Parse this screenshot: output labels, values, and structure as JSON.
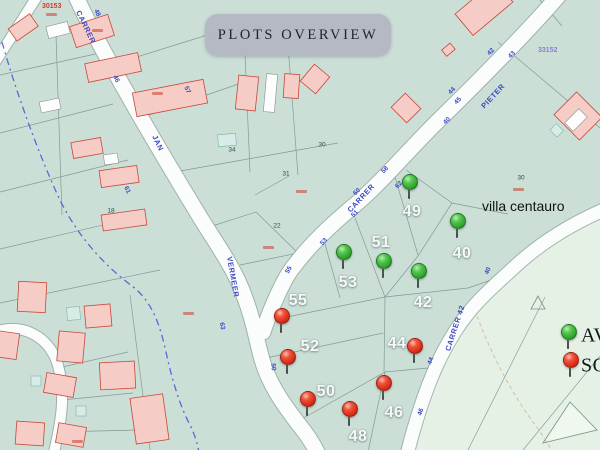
{
  "title": "PLOTS OVERVIEW",
  "area_label": "villa centauro",
  "legend": {
    "available_label": "AV",
    "sold_label": "SO",
    "available_color": "#2fa32d",
    "sold_color": "#d62b16"
  },
  "map": {
    "corner_refs": [
      {
        "text": "30153",
        "x": 42,
        "y": 3,
        "color": "#cf3a2c"
      },
      {
        "text": "33152",
        "x": 538,
        "y": 47,
        "color": "#8a7fd0"
      }
    ],
    "street_labels": [
      {
        "text": "CARRER",
        "x": 86,
        "y": 27,
        "rot": 64
      },
      {
        "text": "JAN",
        "x": 158,
        "y": 143,
        "rot": 64
      },
      {
        "text": "VERMEER",
        "x": 233,
        "y": 277,
        "rot": 80
      },
      {
        "text": "CARRER",
        "x": 361,
        "y": 198,
        "rot": -47
      },
      {
        "text": "PIETER",
        "x": 493,
        "y": 96,
        "rot": -47
      },
      {
        "text": "CARRER 42",
        "x": 455,
        "y": 328,
        "rot": -72
      }
    ],
    "street_numbers": [
      {
        "text": "48",
        "x": 97,
        "y": 13,
        "rot": 64
      },
      {
        "text": "46",
        "x": 116,
        "y": 79,
        "rot": 64
      },
      {
        "text": "61",
        "x": 127,
        "y": 190,
        "rot": 64
      },
      {
        "text": "57",
        "x": 187,
        "y": 90,
        "rot": 64
      },
      {
        "text": "63",
        "x": 222,
        "y": 326,
        "rot": 80
      },
      {
        "text": "50",
        "x": 273,
        "y": 367,
        "rot": 85
      },
      {
        "text": "58",
        "x": 385,
        "y": 170,
        "rot": -47
      },
      {
        "text": "62",
        "x": 399,
        "y": 185,
        "rot": -47
      },
      {
        "text": "60",
        "x": 357,
        "y": 192,
        "rot": -47
      },
      {
        "text": "51",
        "x": 355,
        "y": 214,
        "rot": -47
      },
      {
        "text": "53",
        "x": 324,
        "y": 242,
        "rot": -47
      },
      {
        "text": "55",
        "x": 289,
        "y": 270,
        "rot": -60
      },
      {
        "text": "43",
        "x": 512,
        "y": 55,
        "rot": -47
      },
      {
        "text": "42",
        "x": 491,
        "y": 52,
        "rot": -47
      },
      {
        "text": "44",
        "x": 452,
        "y": 91,
        "rot": -47
      },
      {
        "text": "45",
        "x": 458,
        "y": 101,
        "rot": -47
      },
      {
        "text": "40",
        "x": 447,
        "y": 121,
        "rot": -47
      },
      {
        "text": "40",
        "x": 488,
        "y": 271,
        "rot": -65
      },
      {
        "text": "44",
        "x": 431,
        "y": 361,
        "rot": -70
      },
      {
        "text": "46",
        "x": 421,
        "y": 412,
        "rot": -72
      }
    ],
    "plot_refs": [
      {
        "text": "34",
        "x": 232,
        "y": 150
      },
      {
        "text": "31",
        "x": 286,
        "y": 174
      },
      {
        "text": "30",
        "x": 322,
        "y": 145
      },
      {
        "text": "22",
        "x": 277,
        "y": 226
      },
      {
        "text": "18",
        "x": 111,
        "y": 211
      },
      {
        "text": "30",
        "x": 521,
        "y": 178
      }
    ],
    "red_marks": [
      {
        "x": 46,
        "y": 13
      },
      {
        "x": 92,
        "y": 29
      },
      {
        "x": 152,
        "y": 92
      },
      {
        "x": 296,
        "y": 190
      },
      {
        "x": 263,
        "y": 246
      },
      {
        "x": 513,
        "y": 188
      },
      {
        "x": 183,
        "y": 312
      },
      {
        "x": 72,
        "y": 440
      }
    ],
    "pins": [
      {
        "number": "49",
        "status": "available",
        "pin_x": 409,
        "pin_y": 183,
        "label_x": 412,
        "label_y": 212
      },
      {
        "number": "51",
        "status": "available",
        "pin_x": 383,
        "pin_y": 262,
        "label_x": 381,
        "label_y": 243
      },
      {
        "number": "40",
        "status": "available",
        "pin_x": 457,
        "pin_y": 222,
        "label_x": 462,
        "label_y": 254
      },
      {
        "number": "53",
        "status": "available",
        "pin_x": 343,
        "pin_y": 253,
        "label_x": 348,
        "label_y": 283
      },
      {
        "number": "42",
        "status": "available",
        "pin_x": 418,
        "pin_y": 272,
        "label_x": 423,
        "label_y": 303
      },
      {
        "number": "55",
        "status": "sold",
        "pin_x": 281,
        "pin_y": 317,
        "label_x": 298,
        "label_y": 301
      },
      {
        "number": "52",
        "status": "sold",
        "pin_x": 287,
        "pin_y": 358,
        "label_x": 310,
        "label_y": 347
      },
      {
        "number": "44",
        "status": "sold",
        "pin_x": 414,
        "pin_y": 347,
        "label_x": 397,
        "label_y": 344
      },
      {
        "number": "50",
        "status": "sold",
        "pin_x": 307,
        "pin_y": 400,
        "label_x": 326,
        "label_y": 392
      },
      {
        "number": "46",
        "status": "sold",
        "pin_x": 383,
        "pin_y": 384,
        "label_x": 394,
        "label_y": 413
      },
      {
        "number": "48",
        "status": "sold",
        "pin_x": 349,
        "pin_y": 410,
        "label_x": 358,
        "label_y": 437
      }
    ]
  }
}
